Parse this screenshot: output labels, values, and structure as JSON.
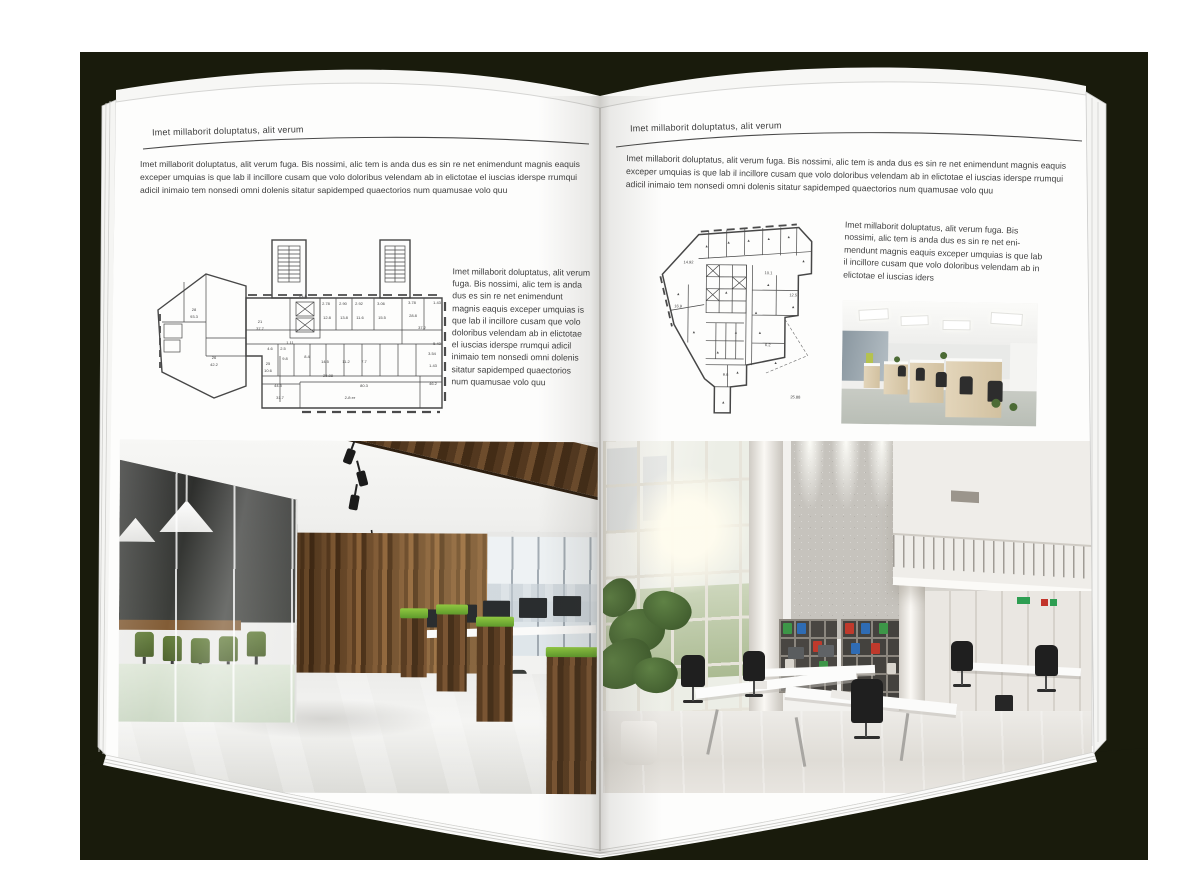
{
  "backdrop_color": "#191b0c",
  "page_color": "#fdfdfc",
  "palette": {
    "wood_wall": "#6b4a2e",
    "grass_green": "#79b342",
    "meeting_chair_green": "#4f6f2f",
    "binder_red": "#bf3a2c",
    "binder_blue": "#2f6cb4",
    "binder_green": "#3d9648",
    "concrete_gray": "#c6c3bd",
    "plan_line": "#474747"
  },
  "left_page": {
    "header": "Imet millaborit doluptatus, alit verum",
    "intro": "Imet millaborit doluptatus, alit verum fuga. Bis nossimi, alic tem is anda dus es sin re net enimendunt magnis eaquis exceper umquias is que lab il incillore cusam que volo doloribus velendam ab in elictotae el iuscias iderspe rrumqui adicil inimaio tem nonsedi omni dolenis sitatur sapidemped quaectorios num quamusae volo quu",
    "side_text": "Imet millaborit doluptatus, alit verum fuga. Bis nossimi, alic tem is anda dus es sin re net enimendunt magnis eaquis exceper umquias is que lab il incillore cusam que volo doloribus velendam ab in elictotae el iuscias iderspe rrumqui adicil inimaio tem nonsedi omni dolenis sitatur sapidemped quaectorios num quamusae volo quu",
    "floorplan_labels": [
      {
        "t": "28",
        "x": 44,
        "y": 84
      },
      {
        "t": "93.3",
        "x": 44,
        "y": 91
      },
      {
        "t": "21",
        "x": 110,
        "y": 96
      },
      {
        "t": "37.7",
        "x": 110,
        "y": 103
      },
      {
        "t": "1.11",
        "x": 140,
        "y": 117
      },
      {
        "t": "26",
        "x": 64,
        "y": 132
      },
      {
        "t": "42.2",
        "x": 64,
        "y": 139
      },
      {
        "t": "25",
        "x": 118,
        "y": 138
      },
      {
        "t": "10.6",
        "x": 118,
        "y": 145
      },
      {
        "t": "2.78",
        "x": 176,
        "y": 78
      },
      {
        "t": "2.90",
        "x": 193,
        "y": 78
      },
      {
        "t": "2.92",
        "x": 209,
        "y": 78
      },
      {
        "t": "3.06",
        "x": 231,
        "y": 78
      },
      {
        "t": "3.78",
        "x": 262,
        "y": 77
      },
      {
        "t": "1.43",
        "x": 287,
        "y": 77
      },
      {
        "t": "12.8",
        "x": 177,
        "y": 92
      },
      {
        "t": "13.8",
        "x": 194,
        "y": 92
      },
      {
        "t": "11.6",
        "x": 210,
        "y": 92
      },
      {
        "t": "15.5",
        "x": 232,
        "y": 92
      },
      {
        "t": "28.8",
        "x": 263,
        "y": 90
      },
      {
        "t": "21.8",
        "x": 153,
        "y": 70
      },
      {
        "t": "37.2",
        "x": 272,
        "y": 102
      },
      {
        "t": "9.8",
        "x": 135,
        "y": 133
      },
      {
        "t": "8.4",
        "x": 157,
        "y": 131
      },
      {
        "t": "14.5",
        "x": 175,
        "y": 136
      },
      {
        "t": "11.2",
        "x": 196,
        "y": 136
      },
      {
        "t": "7.7",
        "x": 214,
        "y": 136
      },
      {
        "t": "44.5",
        "x": 128,
        "y": 160
      },
      {
        "t": "25.88",
        "x": 178,
        "y": 150
      },
      {
        "t": "80.3",
        "x": 214,
        "y": 160
      },
      {
        "t": "2-й эт",
        "x": 200,
        "y": 172
      },
      {
        "t": "31.7",
        "x": 130,
        "y": 172
      },
      {
        "t": "46.2",
        "x": 283,
        "y": 158
      },
      {
        "t": "5.43",
        "x": 287,
        "y": 118
      },
      {
        "t": "3.54",
        "x": 282,
        "y": 128
      },
      {
        "t": "1.43",
        "x": 283,
        "y": 140
      },
      {
        "t": "4.6",
        "x": 120,
        "y": 123
      },
      {
        "t": "2.5",
        "x": 133,
        "y": 123
      }
    ]
  },
  "right_page": {
    "header": "Imet millaborit doluptatus, alit verum",
    "intro": "Imet millaborit doluptatus, alit verum fuga. Bis nossimi, alic tem is anda dus es sin re net enimendunt magnis eaquis exceper umquias is que lab il incillore cusam que volo doloribus velendam ab in elictotae el iuscias iderspe rrumqui adicil inimaio tem nonsedi omni dolenis sitatur sapidemped quaectorios num quamusae volo quu",
    "body_text": "Imet millaborit doluptatus, alit verum fuga. Bis nossimi, alic tem is anda dus es sin re net eni-mendunt magnis eaquis exceper umquias is que lab il incillore cusam que volo doloribus velendam ab in elictotae el iuscias iders",
    "floorplan_labels": [
      {
        "t": "14.92",
        "x": 40,
        "y": 48
      },
      {
        "t": "16.9",
        "x": 30,
        "y": 92
      },
      {
        "t": "10.1",
        "x": 120,
        "y": 58
      },
      {
        "t": "12.5",
        "x": 145,
        "y": 80
      },
      {
        "t": "9.6",
        "x": 78,
        "y": 160
      },
      {
        "t": "6.2",
        "x": 120,
        "y": 130
      },
      {
        "t": "25.88",
        "x": 148,
        "y": 182
      },
      {
        "m": 1,
        "x": 58,
        "y": 32
      },
      {
        "m": 1,
        "x": 80,
        "y": 28
      },
      {
        "m": 1,
        "x": 100,
        "y": 26
      },
      {
        "m": 1,
        "x": 120,
        "y": 24
      },
      {
        "m": 1,
        "x": 140,
        "y": 22
      },
      {
        "m": 1,
        "x": 155,
        "y": 46
      },
      {
        "m": 1,
        "x": 120,
        "y": 70
      },
      {
        "m": 1,
        "x": 145,
        "y": 92
      },
      {
        "m": 1,
        "x": 78,
        "y": 78
      },
      {
        "m": 1,
        "x": 30,
        "y": 80
      },
      {
        "m": 1,
        "x": 46,
        "y": 118
      },
      {
        "m": 1,
        "x": 88,
        "y": 118
      },
      {
        "m": 1,
        "x": 70,
        "y": 138
      },
      {
        "m": 1,
        "x": 112,
        "y": 118
      },
      {
        "m": 1,
        "x": 90,
        "y": 158
      },
      {
        "m": 1,
        "x": 76,
        "y": 188
      },
      {
        "m": 1,
        "x": 128,
        "y": 148
      },
      {
        "m": 1,
        "x": 108,
        "y": 98
      }
    ]
  }
}
